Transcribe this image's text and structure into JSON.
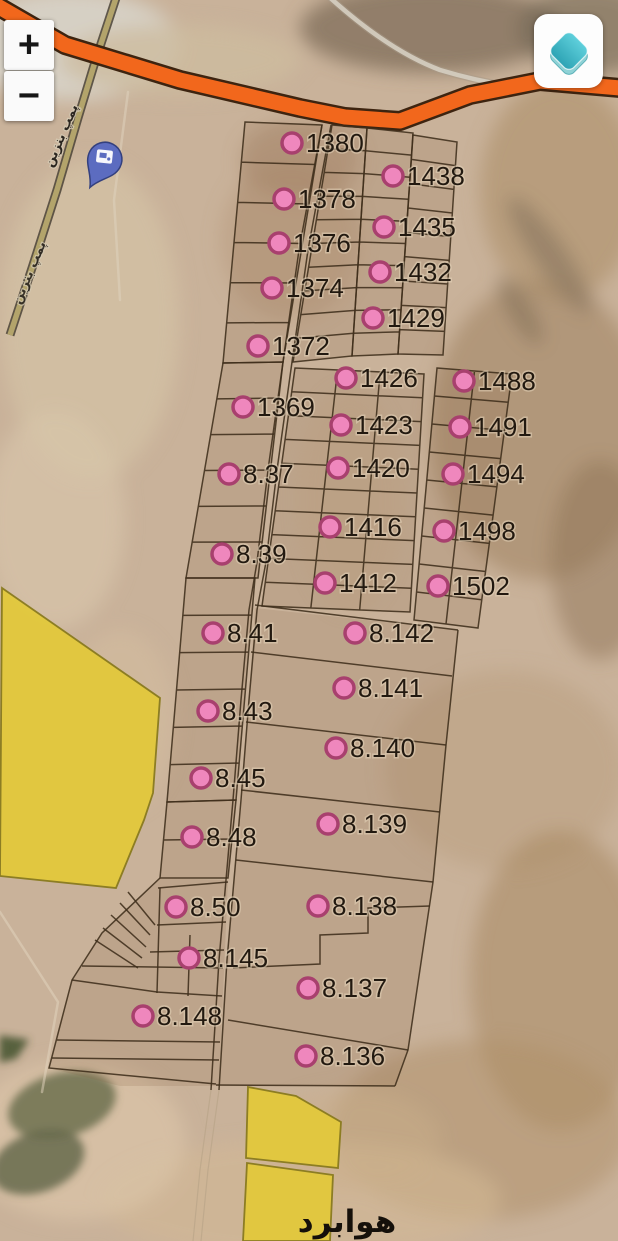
{
  "controls": {
    "zoom_in": "+",
    "zoom_out": "−",
    "layers_icon": "layers-icon"
  },
  "map": {
    "place_label": "هوابرد",
    "road_label": "پمپ بنزین",
    "poi": {
      "icon": "fuel-pump-pin"
    },
    "markers": [
      {
        "label": "1380",
        "x": 292,
        "y": 143
      },
      {
        "label": "1438",
        "x": 393,
        "y": 176
      },
      {
        "label": "1378",
        "x": 284,
        "y": 199
      },
      {
        "label": "1435",
        "x": 384,
        "y": 227
      },
      {
        "label": "1376",
        "x": 279,
        "y": 243
      },
      {
        "label": "1432",
        "x": 380,
        "y": 272
      },
      {
        "label": "1374",
        "x": 272,
        "y": 288
      },
      {
        "label": "1429",
        "x": 373,
        "y": 318
      },
      {
        "label": "1372",
        "x": 258,
        "y": 346
      },
      {
        "label": "1426",
        "x": 346,
        "y": 378
      },
      {
        "label": "1488",
        "x": 464,
        "y": 381
      },
      {
        "label": "1369",
        "x": 243,
        "y": 407
      },
      {
        "label": "1423",
        "x": 341,
        "y": 425
      },
      {
        "label": "1491",
        "x": 460,
        "y": 427
      },
      {
        "label": "8.37",
        "x": 229,
        "y": 474
      },
      {
        "label": "1420",
        "x": 338,
        "y": 468
      },
      {
        "label": "1494",
        "x": 453,
        "y": 474
      },
      {
        "label": "1416",
        "x": 330,
        "y": 527
      },
      {
        "label": "1498",
        "x": 444,
        "y": 531
      },
      {
        "label": "8.39",
        "x": 222,
        "y": 554
      },
      {
        "label": "1412",
        "x": 325,
        "y": 583
      },
      {
        "label": "1502",
        "x": 438,
        "y": 586
      },
      {
        "label": "8.41",
        "x": 213,
        "y": 633
      },
      {
        "label": "8.142",
        "x": 355,
        "y": 633
      },
      {
        "label": "8.141",
        "x": 344,
        "y": 688
      },
      {
        "label": "8.43",
        "x": 208,
        "y": 711
      },
      {
        "label": "8.140",
        "x": 336,
        "y": 748
      },
      {
        "label": "8.45",
        "x": 201,
        "y": 778
      },
      {
        "label": "8.139",
        "x": 328,
        "y": 824
      },
      {
        "label": "8.48",
        "x": 192,
        "y": 837
      },
      {
        "label": "8.50",
        "x": 176,
        "y": 907
      },
      {
        "label": "8.138",
        "x": 318,
        "y": 906
      },
      {
        "label": "8.145",
        "x": 189,
        "y": 958
      },
      {
        "label": "8.137",
        "x": 308,
        "y": 988
      },
      {
        "label": "8.148",
        "x": 143,
        "y": 1016
      },
      {
        "label": "8.136",
        "x": 306,
        "y": 1056
      }
    ]
  },
  "colors": {
    "marker_fill": "#ef87bd",
    "marker_ring": "#a8406e",
    "label": "#221910",
    "highway": "#f2671c",
    "highway_casing": "#3d2410",
    "zone_yellow": "#e2c83d",
    "zone_border": "#8a7b1f",
    "pin_blue": "#5c6cc0",
    "layers_teal": "#45bccb",
    "parcel_line": "#3f2f1b"
  }
}
